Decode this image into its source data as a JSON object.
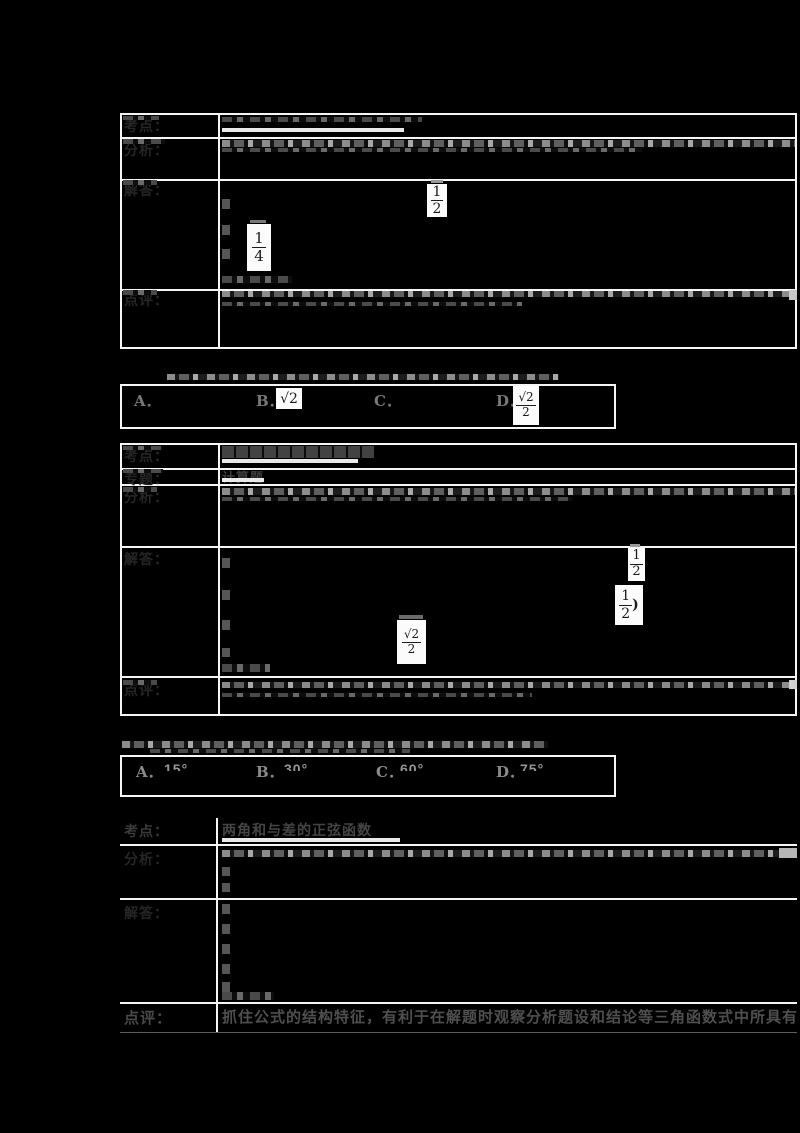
{
  "colors": {
    "background": "#000000",
    "table_border": "#f5f5f5",
    "formula_background": "#fbfbfb",
    "formula_ink": "#1b1b1b"
  },
  "row_labels": {
    "kaodian": "考点：",
    "zhuanti": "专题：",
    "fenxi": "分析：",
    "jieda": "解答：",
    "dianping": "点评："
  },
  "table1": {
    "formulas": {
      "f_half": {
        "num": "1",
        "den": "2"
      },
      "f_quarter": {
        "num": "1",
        "den": "4"
      }
    }
  },
  "question1": {
    "options": [
      {
        "letter": "A．"
      },
      {
        "letter": "B．",
        "value_num": "√2"
      },
      {
        "letter": "C．"
      },
      {
        "letter": "D．",
        "frac": {
          "num": "√2",
          "den": "2"
        }
      }
    ]
  },
  "table2": {
    "zhuanti_text": "计算题",
    "formulas": {
      "f_half": {
        "num": "1",
        "den": "2"
      },
      "f_half_paren": {
        "num": "1",
        "den": "2",
        "suffix": ")"
      },
      "f_sqrt2_over_2": {
        "num": "√2",
        "den": "2"
      }
    }
  },
  "question2": {
    "options": [
      {
        "letter": "A．",
        "value": "15°"
      },
      {
        "letter": "B．",
        "value": "30°"
      },
      {
        "letter": "C．",
        "value": "60°"
      },
      {
        "letter": "D．",
        "value": "75°"
      }
    ]
  },
  "table3": {
    "kaodian_text": "两角和与差的正弦函数",
    "dianping_text": "抓住公式的结构特征，有利于在解题时观察分析题设和结论等三角函数式中所具有的相似性"
  }
}
